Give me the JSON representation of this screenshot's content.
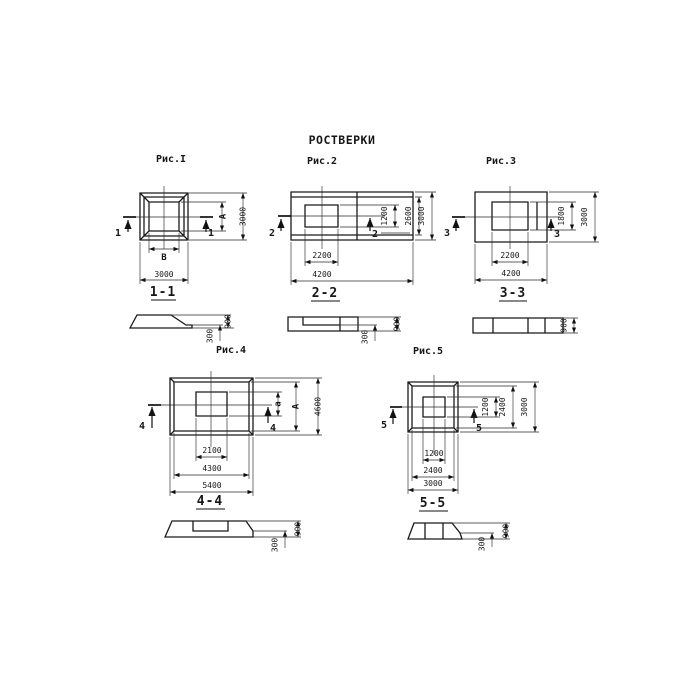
{
  "title": "РОСТВЕРКИ",
  "figures": [
    {
      "caption": "Рис.I",
      "cut_label": "1",
      "section_label": "1-1",
      "plan_dims": {
        "bottom_inner": "В",
        "bottom_outer": "3000",
        "right_inner": "А",
        "right_outer": "3000"
      },
      "section_dims": {
        "total_height": "900",
        "ledge_height": "300"
      }
    },
    {
      "caption": "Рис.2",
      "cut_label": "2",
      "section_label": "2-2",
      "plan_dims": {
        "bottom_inner": "2200",
        "bottom_outer": "4200",
        "right_inner": "1200",
        "right_middle": "2600",
        "right_outer": "3000"
      },
      "section_dims": {
        "total_height": "900",
        "ledge_height": "300"
      }
    },
    {
      "caption": "Рис.3",
      "cut_label": "3",
      "section_label": "3-3",
      "plan_dims": {
        "bottom_inner": "2200",
        "bottom_outer": "4200",
        "right_inner": "1800",
        "right_outer": "3000"
      },
      "section_dims": {
        "total_height": "900"
      }
    },
    {
      "caption": "Рис.4",
      "cut_label": "4",
      "section_label": "4-4",
      "plan_dims": {
        "bottom_inner": "2100",
        "bottom_middle": "4300",
        "bottom_outer": "5400",
        "right_inner": "а",
        "right_middle": "А",
        "right_outer": "4600"
      },
      "section_dims": {
        "total_height": "900",
        "ledge_height": "300"
      }
    },
    {
      "caption": "Рис.5",
      "cut_label": "5",
      "section_label": "5-5",
      "plan_dims": {
        "bottom_inner": "1200",
        "bottom_middle": "2400",
        "bottom_outer": "3000",
        "right_inner": "1200",
        "right_middle": "2400",
        "right_outer": "3000"
      },
      "section_dims": {
        "total_height": "900",
        "ledge_height": "300"
      }
    }
  ]
}
